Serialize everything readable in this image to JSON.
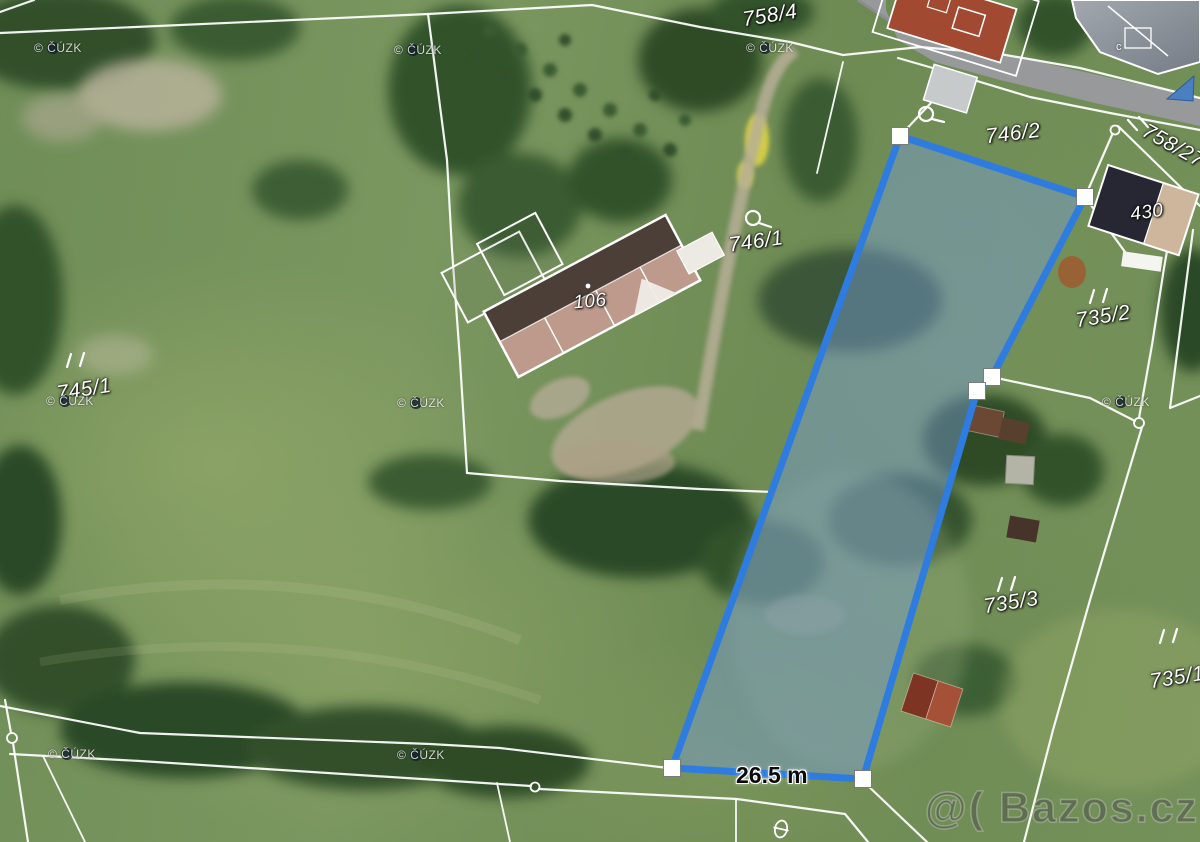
{
  "map": {
    "parcel_labels": {
      "p758_4": "758/4",
      "p746_2": "746/2",
      "p746_1": "746/1",
      "p745_1": "745/1",
      "p735_2": "735/2",
      "p735_3": "735/3",
      "p735_1": "735/1",
      "p758_27": "758/27"
    },
    "building_numbers": {
      "b106": "106",
      "b430": "430",
      "gray_building_mark": "c"
    },
    "measurement": {
      "frontage": "26.5 m"
    },
    "highlight": {
      "stroke_color": "#2e7ce0",
      "fill_color": "rgba(120,158,216,0.45)"
    },
    "watermarks": {
      "cuzk": "© ČÚZK",
      "brand": "@( Bazos.cz"
    }
  }
}
